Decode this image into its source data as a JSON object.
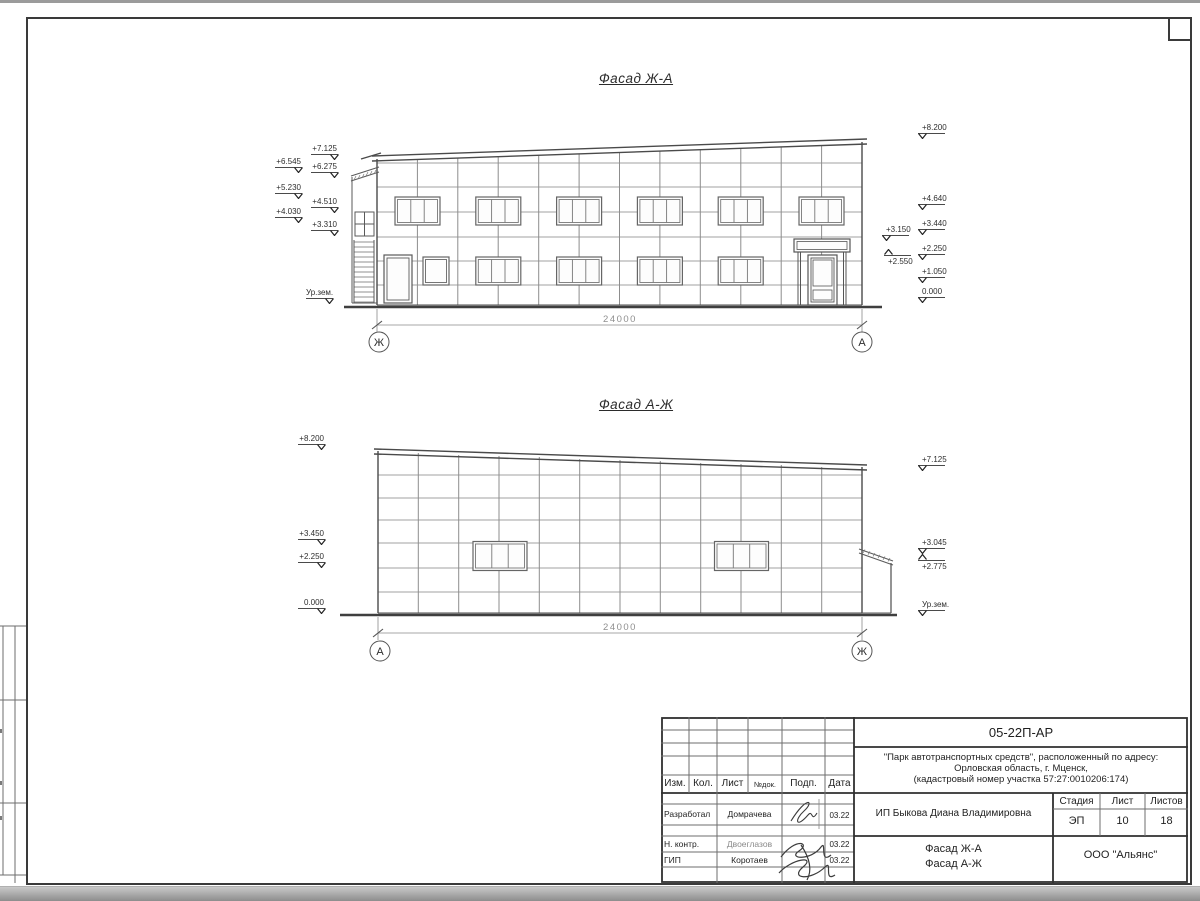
{
  "sheet": {
    "code": "05-22П-АР",
    "org": "ООО \"Альянс\"",
    "client": "ИП Быкова Диана Владимировна",
    "project_line1": "\"Парк автотранспортных средств\",  расположенный по адресу:",
    "project_line2": "Орловская область, г. Мценск,",
    "project_line3": "(кадастровый номер участка 57:27:0010206:174)",
    "doc_title_line1": "Фасад Ж-А",
    "doc_title_line2": "Фасад А-Ж",
    "stage_label": "Стадия",
    "sheet_label": "Лист",
    "sheets_label": "Листов",
    "stage": "ЭП",
    "sheet_no": "10",
    "sheets_total": "18",
    "header_cols": [
      "Изм.",
      "Кол.",
      "Лист",
      "№док.",
      "Подп.",
      "Дата"
    ],
    "roles": [
      {
        "role": "Разработал",
        "name": "Домрачева",
        "date": "03.22"
      },
      {
        "role": "Н. контр.",
        "name": "Двоеглазов",
        "date": "03.22"
      },
      {
        "role": "ГИП",
        "name": "Коротаев",
        "date": "03.22"
      }
    ]
  },
  "facade1": {
    "title": "Фасад Ж-А",
    "dimension": "24000",
    "axis_left": "Ж",
    "axis_right": "А",
    "marks_left": [
      "+7.125",
      "+6.545",
      "+6.275",
      "+5.230",
      "+4.510",
      "+4.030",
      "+3.310",
      "Ур.зем."
    ],
    "marks_right": [
      "+8.200",
      "+4.640",
      "+3.440",
      "+2.250",
      "+1.050",
      "0.000"
    ],
    "marks_inner": [
      "+3.150",
      "+2.550"
    ]
  },
  "facade2": {
    "title": "Фасад А-Ж",
    "dimension": "24000",
    "axis_left": "А",
    "axis_right": "Ж",
    "marks_left": [
      "+8.200",
      "+3.450",
      "+2.250",
      "0.000"
    ],
    "marks_right": [
      "+7.125",
      "+3.045",
      "+2.775",
      "Ур.зем."
    ]
  }
}
